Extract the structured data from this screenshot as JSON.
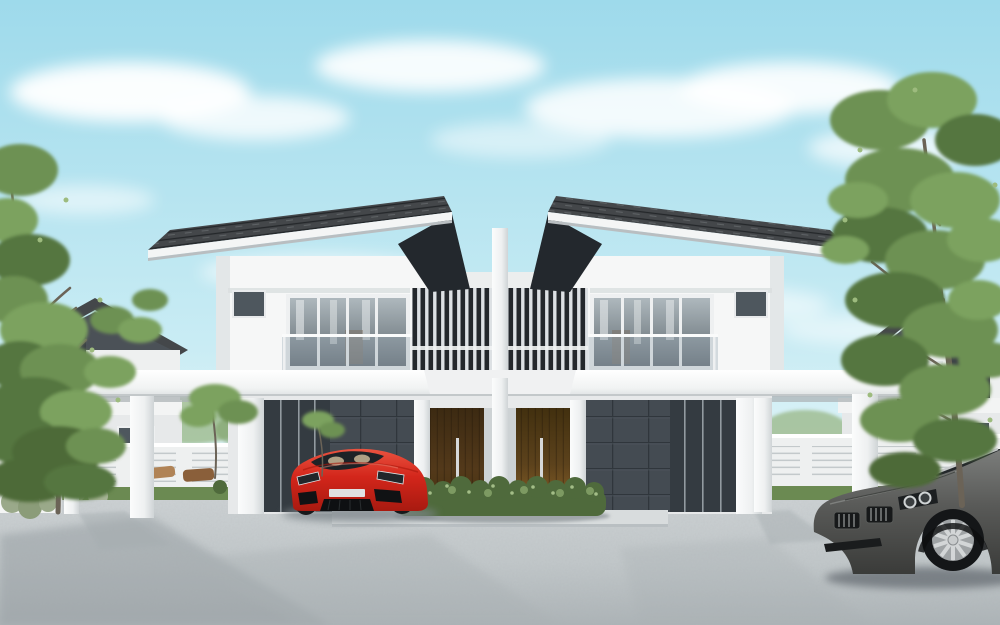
{
  "scene": {
    "title": "Modern duplex house exterior rendering",
    "description": "Architectural 3D rendering of a symmetric two-storey semi-detached duplex with dark pitched roofs, white walls, glass balconies, central vertical louver screens, twin timber entrance doors behind a green hedge, flat carport canopies on both sides, a red sports car parked at the left carport, a grey roadster in the lower right, smaller gabled houses and white fences in the background, large green trees at both edges, and a bright blue sky with soft clouds over a concrete driveway.",
    "objects": {
      "sky": "blue sky with clouds",
      "duplex": "white two-storey duplex house",
      "roofs": "dark grey shingle roofs sloping outward",
      "louver_screen": "central vertical slat screens between units",
      "balcony": "glass balustrade balconies with full-height windows",
      "doors": "two dark timber entry doors with steel pull handles",
      "hedge": "green shrub hedge in front of entrance",
      "carports": "white flat canopy carports on columns",
      "red_car": "red sports car parked at left carport",
      "gray_car": "grey roadster in lower right foreground",
      "background_houses": "gabled houses behind white louvered fences",
      "trees": "tall green trees at left and right edges",
      "driveway": "light concrete driveway with soft shadows"
    }
  },
  "palette": {
    "sky_top": "#9edaeb",
    "sky_mid": "#c9ecf4",
    "sky_low": "#ecf7f9",
    "cloud": "#ffffff",
    "roof_dark": "#44474a",
    "eave_dark": "#23282d",
    "wall_white": "#f6f7f7",
    "wall_shadow": "#dfe3e5",
    "glass_dark": "#343b41",
    "stone_dark": "#444b52",
    "door_wood": "#4a3418",
    "door_wood_light": "#7a5526",
    "handle_silver": "#d6d8d9",
    "hedge_green": "#4f6a3c",
    "lawn_green": "#6b8a52",
    "tree_green": "#6d9152",
    "tree_green_light": "#7ca25e",
    "tree_green_dark": "#55763f",
    "tree_trunk": "#6b6357",
    "fence_white": "#eef0f0",
    "drive_light": "#c9ced0",
    "drive_dark": "#aeb5b8",
    "car_red": "#d3261b",
    "car_gray": "#595a58",
    "rim_silver": "#b5b8b9",
    "tire_black": "#141618"
  }
}
